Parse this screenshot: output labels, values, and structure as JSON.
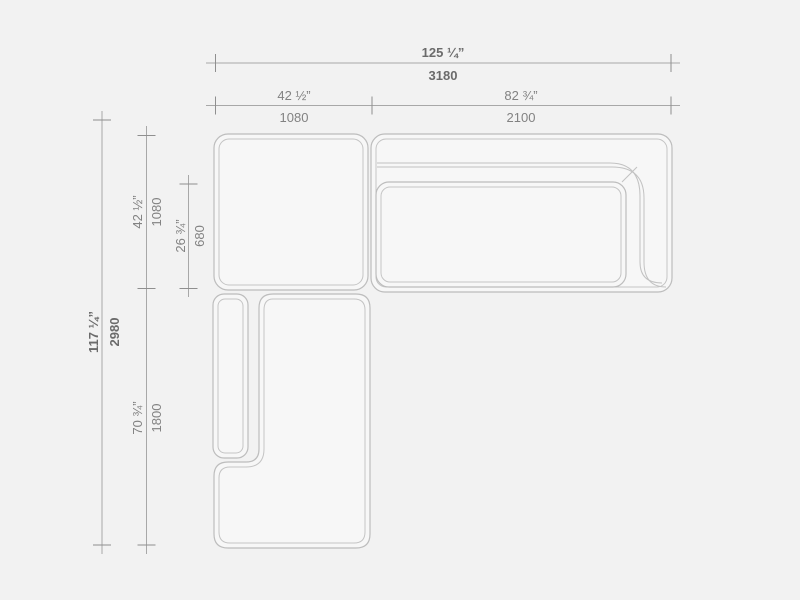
{
  "drawing": {
    "colors": {
      "background": "#f2f2f2",
      "shape_fill": "#f7f7f7",
      "shape_line": "#bdbdbd",
      "dimension_line": "#a8a8a8",
      "label_text": "#828282",
      "label_text_primary": "#6b6b6b"
    },
    "dims": {
      "total_width": {
        "in": "125 ¼”",
        "mm": "3180"
      },
      "corner_width": {
        "in": "42 ½”",
        "mm": "1080"
      },
      "sofa_width": {
        "in": "82 ¾”",
        "mm": "2100"
      },
      "total_depth": {
        "in": "117 ¼”",
        "mm": "2980"
      },
      "corner_depth": {
        "in": "42 ½”",
        "mm": "1080"
      },
      "seat_depth": {
        "in": "26 ¾”",
        "mm": "680"
      },
      "chaise_depth": {
        "in": "70 ¾”",
        "mm": "1800"
      }
    }
  }
}
